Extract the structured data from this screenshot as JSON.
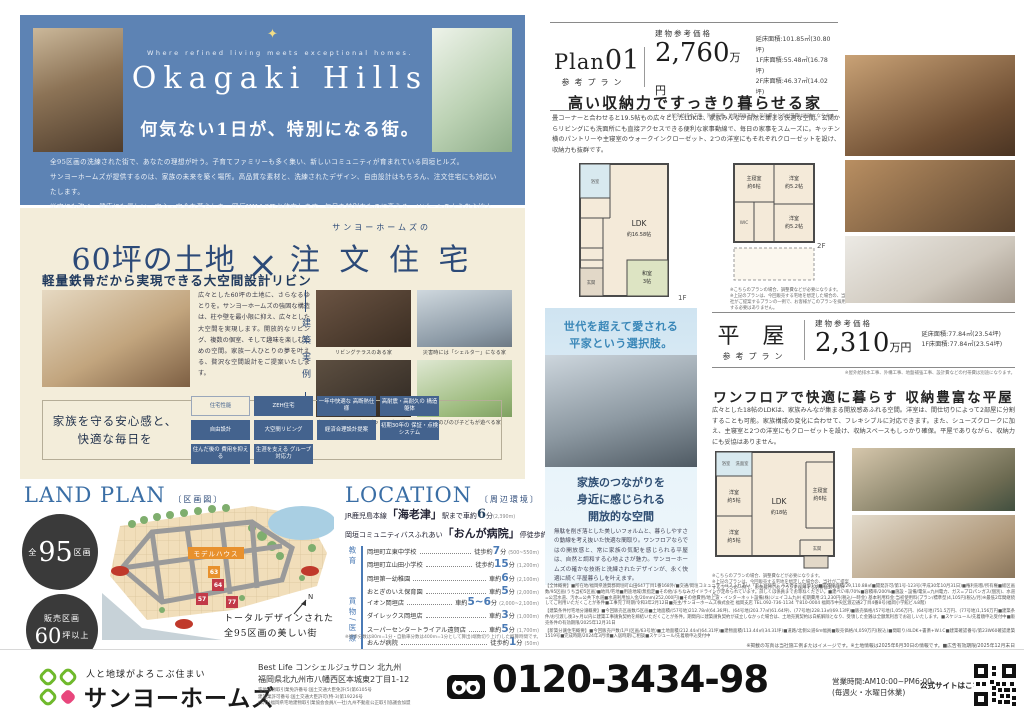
{
  "hero": {
    "tagline": "Where refined living meets exceptional homes.",
    "title": "Okagaki Hills",
    "subtitle": "何気ない1日が、特別になる街。",
    "body_lines": [
      "全95区画の洗練された街で、あなたの理想が叶う。子育てファミリーも多く集い、新しいコミュニティが育まれている岡垣ヒルズ。",
      "サンヨーホームズが提供するのは、家族の未来を築く場所。高品質な素材と、洗練されたデザイン、自由設計はもちろん、注文住宅にも対応いたします。",
      "災害にも強く、健康にも優しい、安心・安全な暮らしを、岡垣HILLSでお約束します。毎日を特別なものに変える、リゾートのような心地よさを、ぜひご体感ください。"
    ]
  },
  "custom": {
    "kicker": "サンヨーホームズの",
    "title_land": "60坪の土地",
    "title_times": "×",
    "title_house": "注 文 住 宅",
    "heading": "軽量鉄骨だから実現できる大空間設計リビング",
    "body": "広々とした60坪の土地に、さらなるゆとりを。サンヨーホームズの強固な構造は、柱や壁を最小限に抑え、広々とした大空間を実現します。開放的なリビング、複数の個室、そして趣味を楽しむための空間。家族一人ひとりの夢を叶える、贅沢な空間設計をご提案いたします。",
    "vertical_label": "建築実例",
    "examples": [
      "リビングテラスのある家",
      "災害時には「シェルター」になる家",
      "ホームシアターになるピットリビングの家",
      "庭でのびのび子どもが遊べる家"
    ],
    "band_title": "家族を守る安心感と、\n快適な毎日を",
    "badges": [
      "住宅性能",
      "ZEH住宅",
      "一年中快適な\n高断熱仕様",
      "高耐震・高耐久の\n構造躯体",
      "自由設計",
      "大空間リビング",
      "経済合理設計提案",
      "初期30年の\n保証・点検システム",
      "住んだ後の\n費用を抑える",
      "生涯を支える\nグループ対応力"
    ]
  },
  "landplan": {
    "title": "LAND PLAN",
    "bracket": "〔区画図〕",
    "circle1_prefix": "全",
    "circle1_num": "95",
    "circle1_suffix": "区画",
    "circle2_line1": "販売区画",
    "circle2_num": "60",
    "circle2_suffix": "坪以上",
    "model_house": "モデルハウス",
    "lots": [
      "63",
      "64",
      "57",
      "77"
    ],
    "compass": "N",
    "caption": "トータルデザインされた\n全95区画の美しい街"
  },
  "location": {
    "title": "LOCATION",
    "bracket": "〔周辺環境〕",
    "unit": "分",
    "head1": {
      "pre": "JR鹿児島本線",
      "station": "「海老津」",
      "mid": "駅まで車約",
      "num": "6",
      "unit": "分",
      "dist": "(2,390m)"
    },
    "head2": {
      "pre": "岡垣コミュニティバスふれあい",
      "station": "「おんが病院」",
      "mid": "停徒歩約",
      "num": "1",
      "unit": "分",
      "dist": "(80m)"
    },
    "groups": [
      {
        "label": "教育",
        "rows": [
          {
            "name": "岡垣町立東中学校",
            "mode": "徒歩約",
            "min": "7",
            "dist": "(500~550m)"
          },
          {
            "name": "岡垣町立山田小学校",
            "mode": "徒歩約",
            "min": "15",
            "dist": "(1,200m)"
          },
          {
            "name": "岡垣第一幼稚園",
            "mode": "車約",
            "min": "6",
            "dist": "(2,100m)"
          },
          {
            "name": "おとぎのいえ保育園",
            "mode": "車約",
            "min": "5",
            "dist": "(2,000m)"
          }
        ]
      },
      {
        "label": "買物/医療",
        "rows": [
          {
            "name": "イオン岡垣店",
            "mode": "車約",
            "min": "5~6",
            "dist": "(2,000~2,100m)"
          },
          {
            "name": "ダイレックス岡垣店",
            "mode": "車約",
            "min": "3",
            "dist": "(1,000m)"
          },
          {
            "name": "スーパーセンタートライアル遠賀店",
            "mode": "車約",
            "min": "5",
            "dist": "(1,700m)"
          },
          {
            "name": "おんが病院",
            "mode": "徒歩約",
            "min": "1",
            "dist": "(50m)"
          },
          {
            "name": "堀病院",
            "mode": "車約",
            "min": "5",
            "dist": "(1,600m)"
          }
        ]
      }
    ],
    "footnote": "※徒歩分数は80m=1分・自動車分数は400m=1分として算出(端数切り上げ)した概算時間です。"
  },
  "plan01": {
    "name": "Plan",
    "num": "01",
    "type_label": "参考プラン",
    "price_label": "建物参考価格",
    "price": "2,760",
    "price_unit": "万円",
    "areas": [
      "延床面積:101.85㎡(30.80坪)",
      "1F床面積:55.48㎡(16.78坪)",
      "2F床面積:46.37㎡(14.02坪)"
    ],
    "price_note": "※屋外給排水工事、外構工事、地盤補強工事、設計費などの付帯費は別途になります。",
    "title": "高い収納力ですっきり暮らせる家",
    "body": "畳コーナーと合わせると19.5帖もの広々としたLDKは、家族みんなが自然と集まる快適な空間。玄関からリビングにも洗面所にも直接アクセスできる便利な家事動線で、毎日の家事をスムーズに。キッチン横のパントリーや主寝室のウォークインクローゼット、2つの洋室にもそれぞれクローゼットを設け、収納力も抜群です。",
    "labels": {
      "ldk1": "LDK",
      "ldk2": "約16.58帖",
      "washitsu1": "和室",
      "washitsu2": "3帖",
      "bath": "浴室",
      "genkan": "玄関",
      "f1": "1F",
      "shu1": "主寝室",
      "shu2": "約6帖",
      "yo1a": "洋室",
      "yo1b": "約5.2帖",
      "yo2a": "洋室",
      "yo2b": "約5.2帖",
      "wic": "WIC",
      "f2": "2F"
    },
    "plan_note": "※こちらのプランの場合、調整費などが必要になります。\n※上記のプランは、今回販売する宅地を想定した場合の、当社がご提案するプランの一例で、お客様がこのプランを採用する必要はありません。"
  },
  "hiraya_panel": {
    "title": "世代を超えて愛される\n平家という選択肢。",
    "subtitle": "家族のつながりを\n身近に感じられる\n開放的な空間",
    "body": "無駄を削ぎ落とした美しいフォルムと、暮らしやすさの動線を考え抜いた快適な間取り。ワンフロアならではの開放感と、常に家族の気配を感じられる平屋は、自然と調和する心地よさが魅力。サンヨーホームズの確かな技術と洗練されたデザインが、永く快適に続く平屋暮らしを叶えます。"
  },
  "hiraya": {
    "name": "平 屋",
    "type_label": "参考プラン",
    "price_label": "建物参考価格",
    "price": "2,310",
    "price_unit": "万円",
    "areas": [
      "延床面積:77.84㎡(23.54坪)",
      "1F床面積:77.84㎡(23.54坪)"
    ],
    "price_note": "※屋外給排水工事、外構工事、地盤補強工事、設計費などの付帯費は別途になります。",
    "title": "ワンフロアで快適に暮らす 収納豊富な平屋",
    "body": "広々とした18帖のLDKは、家族みんなが集まる開放感あふれる空間。洋室は、間仕切りによって2部屋に分割することも可能。家族構成の変化に合わせて、フレキシブルに対応できます。また、シューズクロークに加え、主寝室と2つの洋室にもクローゼットを設け、収納スペースもしっかり確保。平屋でありながら、収納力にも妥協はありません。",
    "labels": {
      "ldk1": "LDK",
      "ldk2": "約18帖",
      "shu1": "主寝室",
      "shu2": "約6帖",
      "yo1a": "洋室",
      "yo1b": "約5帖",
      "yo2a": "洋室",
      "yo2b": "約5帖",
      "bath": "浴室",
      "senmen": "洗面室",
      "genkan": "玄関"
    },
    "plan_note": "※こちらのプランの場合、調整費などが必要になります。\n※上記のプランは、今回販売する宅地を想定した場合の、当社がご提案するプランの一例で、お客様がこのプランを採用する必要はありません。"
  },
  "legal": {
    "p1": "【全体概要】■所在地/福岡県遠賀郡岡垣町山田647丁目1番168外/■交通/岡垣コミュニティバスふれあい「おんが病院」バス停まで徒歩1分■開発総面積/29,110.88㎡■開発許可/第1号-123号(平成30年10月31日)■権利形態/所有権■総区画数/95区画(うち当初5区画)■地目/宅地■用途地域/無指定■その他/まちなみガイドラインが定められています。詳しくは係員までお尋ねください。■建ぺい率/70%■容積率/200%■施設・設備/電気=九州電力、ガス=プロパンガス(個別)、水道=公営水道、汚水=公共下水道■水道利用加入金/20mm(252,000円)■その他費用/地上波・インターネット設備(株)ジェイコム九州 初期費用:21,230円(税込/一時金) 基本利用料金:当初使用料(プラン/標準型)4,105円(税込/月)※最低2年間継続してご利用いただくことが条件■工事完了時期/令和3年2月12日■売主/サンヨーホームズ株式会社 福岡支店 TEL.092-736-1134 〒810-0004 福岡市中央区渡辺通2丁目4番8号(福岡小学館ビル8階)",
    "p2": "【建築条件付宅地分譲概要】■今回販売区画数/5区画■土地面積/(57号地)212.78㎡(64.36坪)、(64号地)203.77㎡(61.64坪)、(77号地)228.13㎡(69.13坪)■販売価格/(57号地)1,056万円、(64号地)751.5万円、(77号地)1,156万円■建築条件/お引渡し後3ヶ月以内に建築工事請負契約を締結いただくことが条件。期間内に建築請負契約が成立しなかった場合は、土地売買契約は白紙解除となり、受領した金銭は全額無利息でお返しいたします。■スケジュール/先着順申込受付中■販売条件の有効期限/2025年12月31日",
    "p3": "【新築分譲住宅概要】■今回販売戸数/1戸(区画/63号地)■土地面積/212.44㎡(64.31坪)■建物面積/113.44㎡(34.31坪)■道路/北側公道6m幅員■販売価格/4,059万円(税込)■間取り/4LDK+書斎+W.I.C■建築確認番号/第23W60確認建築1519号■完成時期/2024年3月頃■入居時期/ご相談■スケジュール/先着順申込受付中",
    "note": "※掲載の写真は当社施工例またはイメージです。※土地情報は2025年6月30日の情報です。■広告有効期限/2025年12月末日"
  },
  "footer": {
    "slogan": "人と地球がよろこぶ住まい",
    "brand": "サンヨーホームズ",
    "office": "Best Life コンシェルジュサロン 北九州",
    "address": "福岡県北九州市八幡西区本城東2丁目1-12",
    "licenses": [
      "宅地建物取引業免許番号:国土交通大臣免許(5)第6105号",
      "建設業許可番号:国土交通大臣許可(特-3)第19226号",
      "(公社)福岡県宅地建物取引業協会会員/(一社)九州不動産公正取引協議会加盟"
    ],
    "phone": "0120-3434-98",
    "hours_1": "営業時間:AM10:00~PM6:00",
    "hours_2": "(毎週火・水曜日休業)",
    "site_label": "公式サイトはこちら▶"
  }
}
